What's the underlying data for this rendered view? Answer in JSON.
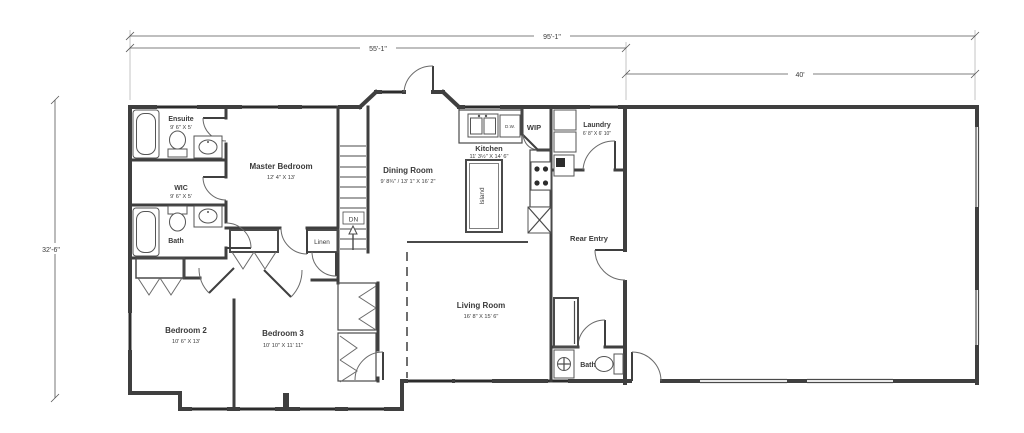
{
  "drawing": {
    "type": "residential floor plan",
    "dimensions": {
      "overall_width": "95'-1\"",
      "main_house_width": "55'-1\"",
      "garage_width": "40'",
      "overall_depth": "32'-6\""
    },
    "rooms": [
      {
        "name": "Ensuite",
        "dims": "9' 6\" X 5'"
      },
      {
        "name": "WIC",
        "dims": "9' 6\" X 5'"
      },
      {
        "name": "Bath",
        "dims": ""
      },
      {
        "name": "Master Bedroom",
        "dims": "12' 4\" X 13'"
      },
      {
        "name": "Linen",
        "dims": ""
      },
      {
        "name": "Dining Room",
        "dims": "9' 8¾\" / 13' 1\" X 16' 2\""
      },
      {
        "name": "Kitchen",
        "dims": "11' 3½\" X 14' 6\""
      },
      {
        "name": "Island",
        "dims": ""
      },
      {
        "name": "WIP",
        "dims": ""
      },
      {
        "name": "Laundry",
        "dims": "6' 8\" X 6' 10\""
      },
      {
        "name": "Rear Entry",
        "dims": ""
      },
      {
        "name": "Living Room",
        "dims": "16' 8\" X 15' 6\""
      },
      {
        "name": "Bedroom 2",
        "dims": "10' 6\" X 13'"
      },
      {
        "name": "Bedroom 3",
        "dims": "10' 10\" X 11' 11\""
      },
      {
        "name": "Bath",
        "dims": ""
      }
    ],
    "annotations": [
      {
        "label": "DN"
      },
      {
        "label": "D.W."
      }
    ]
  }
}
